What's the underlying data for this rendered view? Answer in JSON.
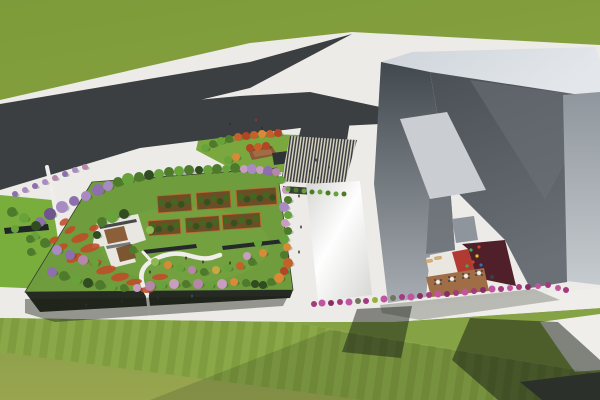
{
  "meta": {
    "description": "Aerial 3D architectural rendering: rooftop garden park beside a large angular gray building with courtyard, Y-shaped asphalt road, striped entry plaza and lawns"
  },
  "palette": {
    "sidewalk": "#ecebe7",
    "grass_top_a": "#7d9b3a",
    "grass_top_b": "#88a23f",
    "grass_bot_a": "#8ba04a",
    "grass_bot_b": "#99a54f",
    "lawn_right": "#85a244",
    "lawn_stripe_a": "#7f9c3e",
    "lawn_stripe_b": "#8aa847",
    "left_lawn": "#79ad3c",
    "entr_lawn": "#7aa83e",
    "road": "#3b3f42",
    "asphalt2": "#46494b",
    "plaza_dark": "#3c4043",
    "plaza_cream": "#d7d1bf",
    "garden_lawn": "#6f9c3c",
    "garden_lawn_hi": "#7aa844",
    "garden_facade": "#252a22",
    "wing_hi": "#fefefe",
    "wing_lo": "#d6d6d3",
    "parapet": "#ced4da",
    "parapet_hi": "#e3e7eb",
    "west_top": "#41484e",
    "west_bot": "#a7adb2",
    "valley_top": "#4a5056",
    "valley_bot": "#6a7076",
    "facet": "#6b7177",
    "right_top": "#8f969d",
    "right_bot": "#c6cbcf",
    "sky1": "#caced3",
    "sky2": "#8e959c",
    "court_white": "#eae6e0",
    "court_red": "#b13b33",
    "court_maroon": "#4f1f2a",
    "court_deck": "#a06e46",
    "lounger": "#d9b06a",
    "amphi": "#8a5a38",
    "amphi_hi": "#a9744a",
    "canopy_dark": "#2e3336",
    "pergola": "#202526",
    "bench": "#25292b",
    "path_white": "#efeeea",
    "flower": "#c14a28",
    "shadow": "#1a2016",
    "bed_soil": "#6b4d26",
    "bed_edge": "#c06a2c",
    "bed_tree_a": "#33531e",
    "bed_tree_b": "#44671f",
    "pav_white": "#e9e7e1",
    "pav_deck1": "#8a5f39",
    "pav_deck2": "#7c5531",
    "pav_wall": "#2a2e30",
    "tree_colors": {
      "g1": "#4e7a2c",
      "g2": "#68a23b",
      "g3": "#2f4d20",
      "g4": "#8db954",
      "p1": "#8d6fae",
      "p2": "#a98bc4",
      "p3": "#6e5590",
      "pk": "#c79ec0",
      "pk2": "#b787ab",
      "o1": "#c2622a",
      "o2": "#d88a36",
      "r1": "#b34424",
      "y1": "#c9a93f",
      "m1": "#a23a7c",
      "m2": "#c055a0",
      "m3": "#872e66",
      "sh_gray": "#70755f",
      "sh_yg": "#9aaf3f"
    },
    "people_colors": {
      "dark": "#2e2e2e",
      "red": "#a03535",
      "blue": "#33568e"
    },
    "play_colors": {
      "pe_green": "#3fae49",
      "pe_yellow": "#e8c22a",
      "pe_red": "#d2412e",
      "pe_blue": "#2e6fbe"
    }
  },
  "scene": {
    "trees": [
      [
        98,
        190,
        6,
        "p1"
      ],
      [
        108,
        186,
        5,
        "p2"
      ],
      [
        118,
        182,
        5,
        "g1"
      ],
      [
        128,
        179,
        6,
        "g2"
      ],
      [
        139,
        177,
        5,
        "g1"
      ],
      [
        149,
        175,
        5,
        "g3"
      ],
      [
        159,
        174,
        5,
        "g2"
      ],
      [
        169,
        172,
        5,
        "g1"
      ],
      [
        179,
        171,
        5,
        "g2"
      ],
      [
        189,
        170,
        5,
        "g1"
      ],
      [
        199,
        170,
        4,
        "g3"
      ],
      [
        208,
        170,
        5,
        "g2"
      ],
      [
        217,
        169,
        5,
        "g1"
      ],
      [
        226,
        169,
        4,
        "g2"
      ],
      [
        235,
        168,
        5,
        "g1"
      ],
      [
        244,
        169,
        4,
        "pk"
      ],
      [
        252,
        169,
        5,
        "p2"
      ],
      [
        260,
        170,
        4,
        "pk"
      ],
      [
        268,
        171,
        5,
        "p1"
      ],
      [
        276,
        172,
        4,
        "pk2"
      ],
      [
        281,
        180,
        4,
        "g2"
      ],
      [
        286,
        190,
        4,
        "pk"
      ],
      [
        288,
        200,
        4,
        "g1"
      ],
      [
        284,
        207,
        5,
        "p2"
      ],
      [
        288,
        215,
        4,
        "g2"
      ],
      [
        285,
        223,
        4,
        "pk"
      ],
      [
        288,
        231,
        4,
        "g1"
      ],
      [
        284,
        239,
        5,
        "g2"
      ],
      [
        287,
        247,
        4,
        "o2"
      ],
      [
        284,
        255,
        4,
        "g1"
      ],
      [
        288,
        263,
        5,
        "o1"
      ],
      [
        284,
        271,
        4,
        "r1"
      ],
      [
        279,
        278,
        5,
        "o2"
      ],
      [
        271,
        282,
        4,
        "g1"
      ],
      [
        263,
        285,
        4,
        "g3"
      ],
      [
        52,
        272,
        5,
        "p1"
      ],
      [
        64,
        276,
        5,
        "g1"
      ],
      [
        76,
        280,
        5,
        "g2"
      ],
      [
        88,
        283,
        5,
        "g3"
      ],
      [
        100,
        285,
        5,
        "g1"
      ],
      [
        112,
        287,
        4,
        "g2"
      ],
      [
        124,
        288,
        4,
        "g1"
      ],
      [
        137,
        288,
        4,
        "pk"
      ],
      [
        150,
        286,
        5,
        "pk2"
      ],
      [
        162,
        285,
        4,
        "g2"
      ],
      [
        174,
        284,
        5,
        "pk"
      ],
      [
        186,
        284,
        4,
        "g1"
      ],
      [
        198,
        284,
        5,
        "pk2"
      ],
      [
        210,
        285,
        4,
        "g2"
      ],
      [
        222,
        284,
        5,
        "pk"
      ],
      [
        234,
        282,
        4,
        "o2"
      ],
      [
        246,
        283,
        4,
        "g1"
      ],
      [
        255,
        284,
        4,
        "g3"
      ],
      [
        40,
        222,
        5,
        "p1"
      ],
      [
        50,
        214,
        6,
        "p3"
      ],
      [
        62,
        207,
        6,
        "p2"
      ],
      [
        74,
        201,
        5,
        "p1"
      ],
      [
        86,
        196,
        5,
        "p2"
      ],
      [
        35,
        236,
        4,
        "g2"
      ],
      [
        45,
        243,
        5,
        "g1"
      ],
      [
        57,
        250,
        5,
        "p2"
      ],
      [
        70,
        255,
        5,
        "p1"
      ],
      [
        83,
        260,
        5,
        "pk2"
      ],
      [
        95,
        263,
        4,
        "g2"
      ],
      [
        31,
        252,
        4,
        "g1"
      ],
      [
        150,
        230,
        4,
        "g4"
      ],
      [
        155,
        262,
        4,
        "g4"
      ],
      [
        168,
        265,
        4,
        "o2"
      ],
      [
        180,
        268,
        4,
        "g2"
      ],
      [
        192,
        270,
        4,
        "pk2"
      ],
      [
        204,
        272,
        4,
        "g1"
      ],
      [
        216,
        270,
        4,
        "y1"
      ],
      [
        228,
        268,
        4,
        "g2"
      ],
      [
        240,
        266,
        4,
        "o1"
      ],
      [
        252,
        262,
        4,
        "g1"
      ],
      [
        258,
        243,
        4,
        "g2"
      ],
      [
        263,
        253,
        4,
        "o2"
      ],
      [
        247,
        256,
        4,
        "pk"
      ],
      [
        102,
        222,
        5,
        "g1"
      ],
      [
        112,
        217,
        6,
        "g2"
      ],
      [
        124,
        214,
        5,
        "g3"
      ],
      [
        97,
        235,
        4,
        "g3"
      ],
      [
        133,
        250,
        4,
        "g1"
      ],
      [
        205,
        148,
        4,
        "g2"
      ],
      [
        213,
        144,
        4,
        "g1"
      ],
      [
        221,
        141,
        4,
        "g2"
      ],
      [
        229,
        139,
        4,
        "g1"
      ],
      [
        238,
        137,
        4,
        "o1"
      ],
      [
        246,
        136,
        4,
        "r1"
      ],
      [
        254,
        135,
        4,
        "o1"
      ],
      [
        262,
        134,
        4,
        "o2"
      ],
      [
        270,
        134,
        4,
        "o1"
      ],
      [
        278,
        133,
        4,
        "r1"
      ],
      [
        250,
        148,
        4,
        "r1"
      ],
      [
        258,
        147,
        4,
        "o1"
      ],
      [
        266,
        146,
        4,
        "r1"
      ],
      [
        228,
        160,
        4,
        "g2"
      ],
      [
        236,
        157,
        4,
        "o2"
      ],
      [
        12,
        212,
        5,
        "g1"
      ],
      [
        24,
        218,
        5,
        "g2"
      ],
      [
        36,
        226,
        5,
        "g3"
      ],
      [
        15,
        229,
        4,
        "g2"
      ],
      [
        30,
        239,
        4,
        "g1"
      ],
      [
        15,
        194,
        3,
        "p1"
      ],
      [
        25,
        190,
        3,
        "p2"
      ],
      [
        35,
        186,
        3,
        "p1"
      ],
      [
        45,
        182,
        3,
        "p2"
      ],
      [
        55,
        178,
        3,
        "pk2"
      ],
      [
        65,
        174,
        3,
        "p1"
      ],
      [
        75,
        170,
        3,
        "p2"
      ],
      [
        85,
        167,
        3,
        "pk2"
      ]
    ],
    "magenta_shrubs": [
      [
        314,
        304,
        3,
        "m1"
      ],
      [
        322,
        303,
        3.5,
        "m2"
      ],
      [
        331,
        303,
        3,
        "m3"
      ],
      [
        340,
        302,
        3,
        "m1"
      ],
      [
        349,
        302,
        3.5,
        "m2"
      ],
      [
        358,
        301,
        3,
        "sh_gray"
      ],
      [
        366,
        301,
        3,
        "m1"
      ],
      [
        375,
        300,
        3,
        "sh_yg"
      ],
      [
        384,
        299,
        3.5,
        "m2"
      ],
      [
        393,
        298,
        3,
        "sh_gray"
      ],
      [
        402,
        297,
        3,
        "m1"
      ],
      [
        411,
        297,
        3.5,
        "m2"
      ],
      [
        420,
        296,
        3,
        "m3"
      ],
      [
        429,
        295,
        3,
        "m1"
      ],
      [
        438,
        294,
        3.5,
        "m2"
      ],
      [
        447,
        294,
        3,
        "m3"
      ],
      [
        456,
        293,
        3,
        "m1"
      ],
      [
        465,
        292,
        3.5,
        "m2"
      ],
      [
        474,
        291,
        3,
        "m1"
      ],
      [
        483,
        290,
        3,
        "m3"
      ],
      [
        492,
        289,
        3.5,
        "m2"
      ],
      [
        501,
        289,
        3,
        "m1"
      ],
      [
        510,
        288,
        3,
        "m2"
      ],
      [
        519,
        287,
        3,
        "m1"
      ],
      [
        528,
        287,
        3,
        "m3"
      ],
      [
        538,
        286,
        3,
        "m2"
      ],
      [
        548,
        285,
        3,
        "m1"
      ],
      [
        558,
        288,
        3,
        "m2"
      ],
      [
        566,
        290,
        3,
        "m1"
      ]
    ],
    "canopy_shrubs": [
      [
        288,
        189
      ],
      [
        296,
        190
      ],
      [
        304,
        191
      ],
      [
        312,
        192
      ],
      [
        320,
        192
      ],
      [
        328,
        193
      ],
      [
        336,
        194
      ],
      [
        344,
        194
      ]
    ],
    "flower_patches": [
      [
        80,
        238,
        9,
        4,
        -20
      ],
      [
        90,
        248,
        10,
        4,
        -15
      ],
      [
        74,
        258,
        8,
        4,
        -25
      ],
      [
        96,
        263,
        6,
        3,
        -15
      ],
      [
        106,
        270,
        10,
        4,
        -12
      ],
      [
        120,
        277,
        9,
        4,
        -10
      ],
      [
        134,
        282,
        8,
        3,
        -8
      ],
      [
        62,
        247,
        6,
        3,
        -20
      ],
      [
        54,
        240,
        5,
        3,
        -25
      ],
      [
        160,
        277,
        8,
        3,
        -5
      ],
      [
        147,
        290,
        7,
        3,
        0
      ],
      [
        70,
        230,
        6,
        3,
        -30
      ],
      [
        64,
        222,
        5,
        3,
        -35
      ],
      [
        94,
        228,
        5,
        3,
        -20
      ]
    ],
    "orchard_beds": [
      [
        157,
        196,
        34,
        17,
        -4
      ],
      [
        196,
        193,
        34,
        17,
        -4
      ],
      [
        236,
        190,
        40,
        17,
        -4
      ],
      [
        148,
        221,
        32,
        15,
        -4
      ],
      [
        185,
        218,
        34,
        15,
        -4
      ],
      [
        222,
        215,
        38,
        15,
        -4
      ]
    ],
    "benches": [
      "143,250 196,244 197,248 144,254",
      "222,246 284,239 285,243 223,250"
    ],
    "tables": [
      [
        438,
        282
      ],
      [
        452,
        279
      ],
      [
        466,
        276
      ],
      [
        479,
        273
      ]
    ],
    "dark_table": [
      492,
      277
    ],
    "loungers": [
      [
        429,
        261,
        -8
      ],
      [
        438,
        258,
        -8
      ]
    ],
    "play_equipment": [
      [
        471,
        250,
        "pe_green"
      ],
      [
        477,
        256,
        "pe_yellow"
      ],
      [
        473,
        262,
        "pe_red"
      ],
      [
        481,
        265,
        "pe_blue"
      ],
      [
        467,
        266,
        "pe_green"
      ],
      [
        479,
        247,
        "pe_red"
      ]
    ],
    "people": [
      [
        150,
        272,
        "dark"
      ],
      [
        186,
        258,
        "dark"
      ],
      [
        203,
        262,
        "dark"
      ],
      [
        230,
        263,
        "dark"
      ],
      [
        299,
        196,
        "dark"
      ],
      [
        301,
        227,
        "dark"
      ],
      [
        299,
        252,
        "dark"
      ],
      [
        310,
        171,
        "dark"
      ],
      [
        318,
        178,
        "dark"
      ],
      [
        230,
        124,
        "dark"
      ],
      [
        256,
        120,
        "red"
      ],
      [
        262,
        128,
        "dark"
      ],
      [
        86,
        305,
        "dark"
      ],
      [
        122,
        301,
        "dark"
      ],
      [
        158,
        298,
        "dark"
      ],
      [
        192,
        296,
        "blue"
      ],
      [
        316,
        160,
        "dark"
      ],
      [
        329,
        167,
        "dark"
      ]
    ]
  }
}
